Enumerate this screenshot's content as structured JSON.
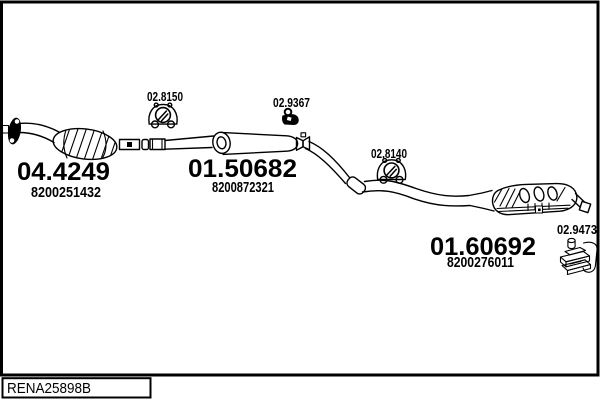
{
  "drawing": {
    "footer_code": "RENA25898B",
    "labels": {
      "hanger_front": "02.8150",
      "clamp_mid": "02.9367",
      "hanger_rear": "02.8140",
      "bracket_rear": "02.9473"
    },
    "parts": {
      "catalytic_converter": {
        "code": "04.4249",
        "oem": "8200251432"
      },
      "centre_silencer": {
        "code": "01.50682",
        "oem": "8200872321"
      },
      "rear_silencer": {
        "code": "01.60692",
        "oem": "8200276011"
      }
    },
    "colors": {
      "ink": "#000000",
      "paper": "#ffffff"
    }
  }
}
